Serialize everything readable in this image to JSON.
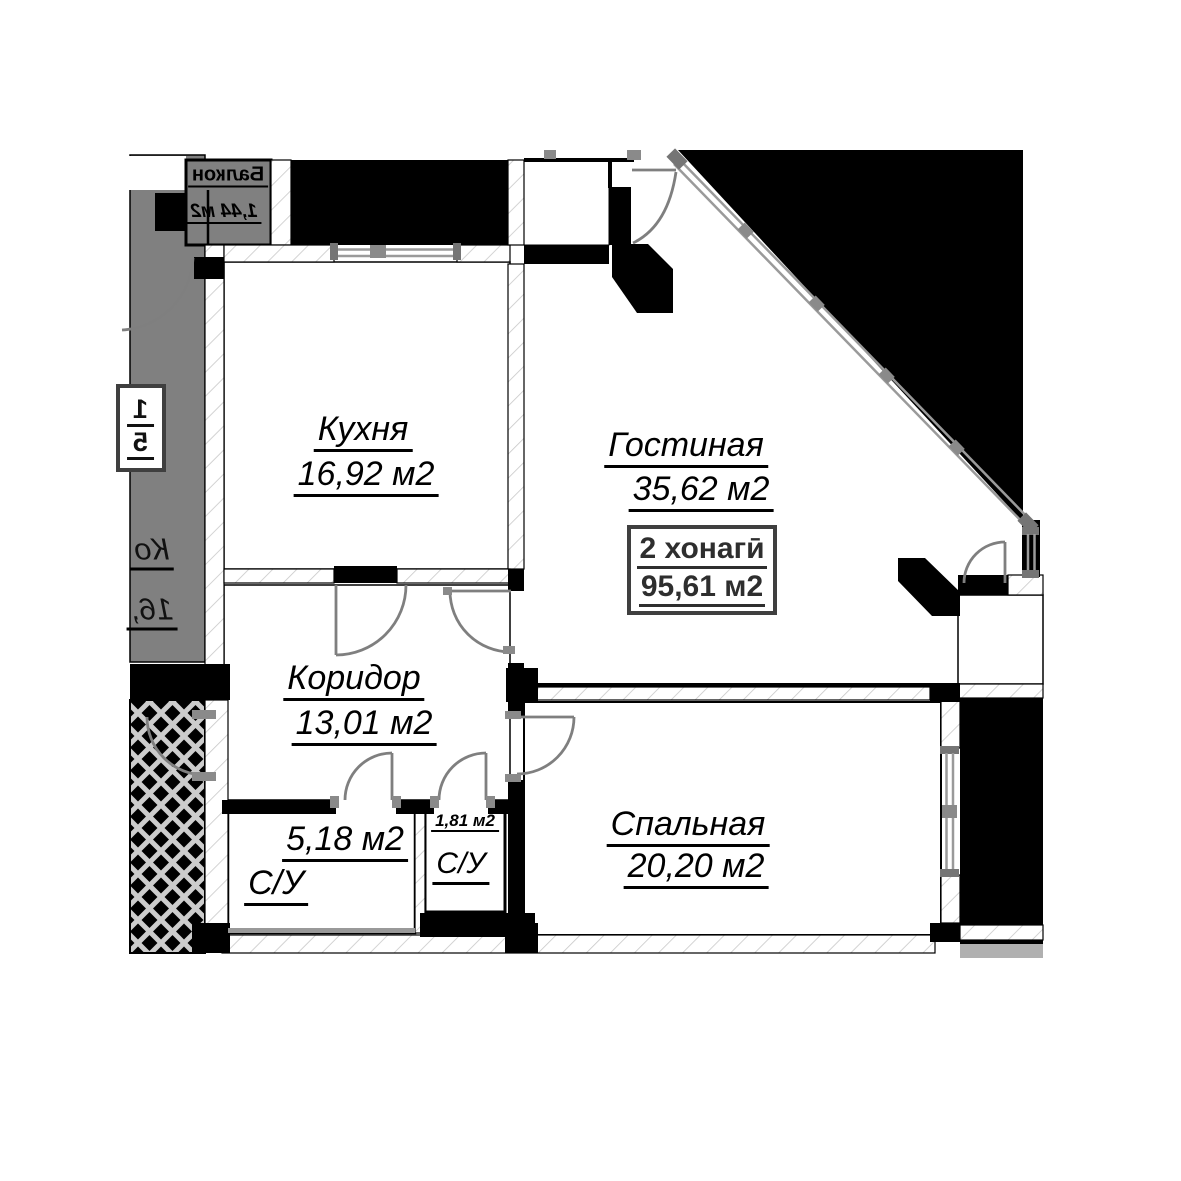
{
  "unit_summary": {
    "type_label": "2 хонагӣ",
    "total_area": "95,61 м2"
  },
  "rooms": {
    "kitchen": {
      "name": "Кухня",
      "area": "16,92 м2"
    },
    "living": {
      "name": "Гостиная",
      "area": "35,62 м2"
    },
    "corridor": {
      "name": "Коридор",
      "area": "13,01 м2"
    },
    "bedroom": {
      "name": "Спальная",
      "area": "20,20 м2"
    },
    "bath_large": {
      "name": "С/У",
      "area": "5,18 м2"
    },
    "bath_small": {
      "name": "С/У",
      "area": "1,81 м2"
    }
  },
  "neighbor": {
    "balcony": {
      "name": "Балкон",
      "area": "1,44 м2"
    },
    "unit_box": {
      "line1": "1",
      "line2": "5"
    },
    "partial_label": {
      "line1": "Ко",
      "line2": "16,"
    }
  },
  "colors": {
    "wall": "#000000",
    "neighbor_fill": "#808080",
    "hatch_line": "#c8c8c8",
    "window": "#9a9a9a",
    "door_arc": "#7f7f7f",
    "box_border": "#3f3f3f",
    "lower_strip": "#b0b0b0"
  }
}
